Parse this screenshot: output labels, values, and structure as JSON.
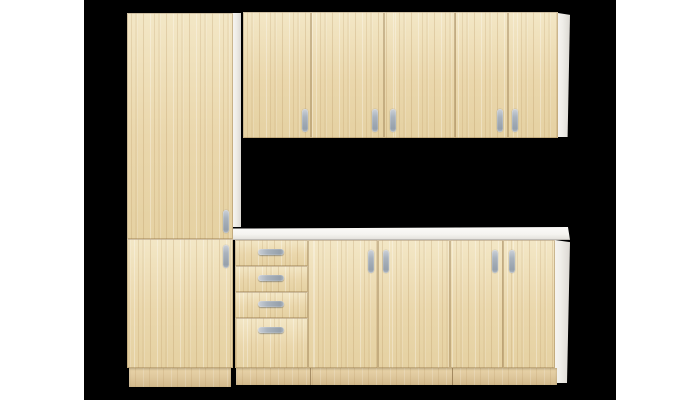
{
  "scene": {
    "type": "product photo",
    "subject": "kitchen cabinet set, light oak sonoma finish",
    "background": {
      "page": "#ffffff",
      "photo": "#000000"
    },
    "components": {
      "tall_cabinet": {
        "label": "tall pantry cabinet",
        "doors": 2,
        "handles": 2
      },
      "wall_cabinets": {
        "label": "wall cabinets",
        "units": 3,
        "doors": 5,
        "handles": 5
      },
      "base_cabinets": {
        "label": "base door cabinets",
        "units": 2,
        "doors": 4,
        "handles": 4
      },
      "drawer_unit": {
        "label": "drawer unit",
        "drawers": 4,
        "handles": 4
      },
      "countertop": {
        "label": "white worktop"
      },
      "side_panels": {
        "label": "white carcass side panels",
        "count": 3
      },
      "plinth": {
        "label": "kick board plinth",
        "segments": 2
      }
    },
    "handle_total": 15
  },
  "palette": {
    "wood": "#ead7ac",
    "wood-light": "#f3e7c6",
    "wood-grain": "#a9814a",
    "wood-dark": "#d9bf92",
    "edge-line": "#927346",
    "panel-white": "#efede8",
    "panel-shadow": "#dcd9d3",
    "countertop-white": "#f5f4f0",
    "handle-metal": "#aab3bd",
    "handle-light": "#ccd1d8",
    "plinth-wood": "#e0c99e",
    "photo-bg": "#000000",
    "page-bg": "#ffffff"
  }
}
